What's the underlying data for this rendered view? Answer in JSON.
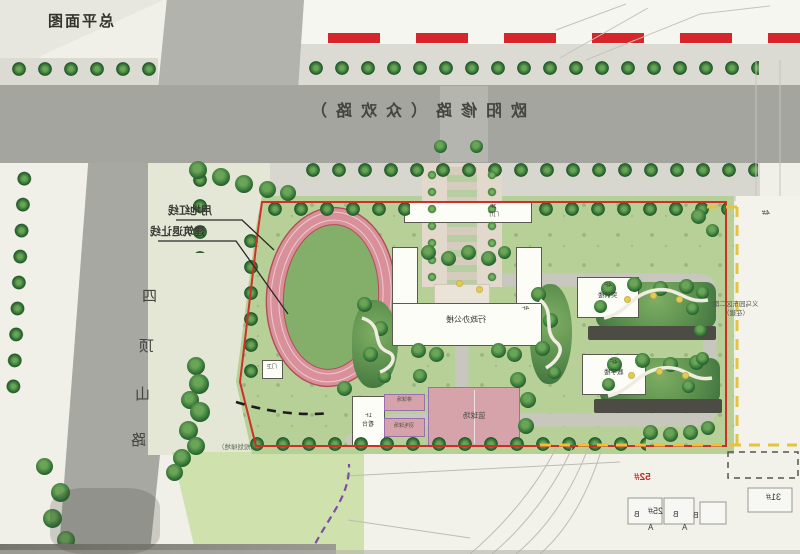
{
  "title": "总平面图",
  "roads": {
    "main": "欧阳修路（众欢路）",
    "west_chars": [
      "四",
      "顶",
      "山",
      "路"
    ]
  },
  "annotations": {
    "red_line_label": "用地红线",
    "setback_label": "建筑退让线",
    "lawn_note": "（规划绿地）",
    "adjacent_line1": "义乌园东区二期",
    "adjacent_line2": "（在建）"
  },
  "buildings": {
    "gate": {
      "name": "门厅",
      "floors": "3F"
    },
    "admin": {
      "name": "行政办公楼",
      "floors": "4F"
    },
    "north_teach": {
      "name": "实训楼",
      "floors": "4F"
    },
    "south_teach": {
      "name": "教学楼",
      "floors": "4F"
    },
    "stand": {
      "name": "看台",
      "floors": "1F"
    },
    "guard": {
      "name": "门卫"
    }
  },
  "courts": {
    "main": "篮球场",
    "small_top": "排球场",
    "small_bottom": "羽毛球场"
  },
  "plots": {
    "red_no": "52#",
    "no25": "25#",
    "no31": "31#",
    "no4": "4#",
    "mark_a": "A",
    "mark_b": "B"
  },
  "colors": {
    "boundary_red": "#cf2f27",
    "setback_yellow": "#e6c33c",
    "pipeline_purple": "#7a50a2",
    "track_pink": "#d8919b",
    "road_gray": "#a4a59f"
  }
}
